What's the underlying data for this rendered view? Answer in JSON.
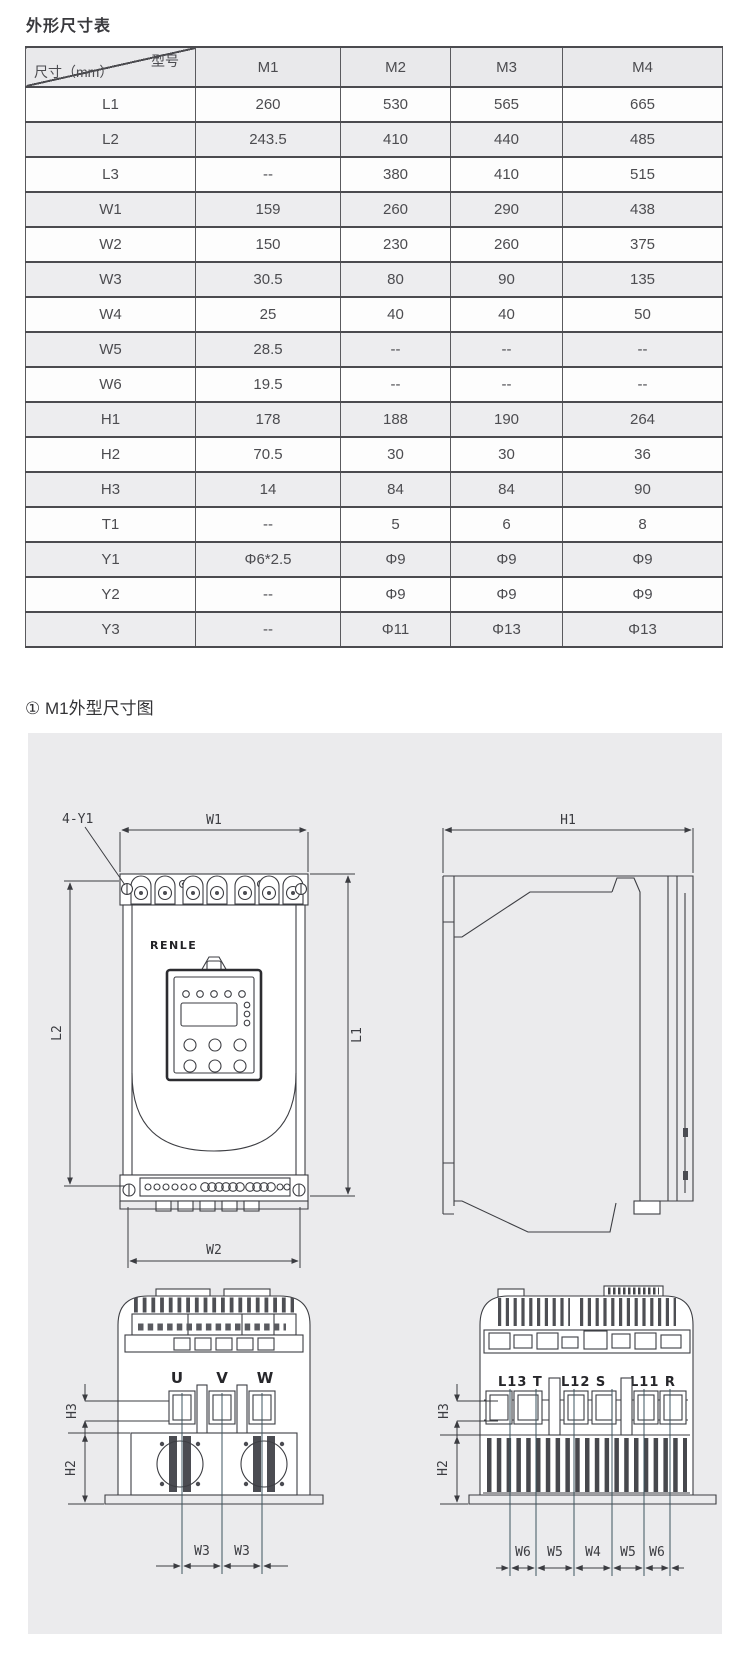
{
  "titles": {
    "table_title": "外形尺寸表",
    "section_title": "① M1外型尺寸图"
  },
  "table": {
    "corner": {
      "top_right": "型号",
      "bottom_left": "尺寸（mm）"
    },
    "columns": [
      "M1",
      "M2",
      "M3",
      "M4"
    ],
    "rows": [
      {
        "label": "L1",
        "values": [
          "260",
          "530",
          "565",
          "665"
        ]
      },
      {
        "label": "L2",
        "values": [
          "243.5",
          "410",
          "440",
          "485"
        ]
      },
      {
        "label": "L3",
        "values": [
          "--",
          "380",
          "410",
          "515"
        ]
      },
      {
        "label": "W1",
        "values": [
          "159",
          "260",
          "290",
          "438"
        ]
      },
      {
        "label": "W2",
        "values": [
          "150",
          "230",
          "260",
          "375"
        ]
      },
      {
        "label": "W3",
        "values": [
          "30.5",
          "80",
          "90",
          "135"
        ]
      },
      {
        "label": "W4",
        "values": [
          "25",
          "40",
          "40",
          "50"
        ]
      },
      {
        "label": "W5",
        "values": [
          "28.5",
          "--",
          "--",
          "--"
        ]
      },
      {
        "label": "W6",
        "values": [
          "19.5",
          "--",
          "--",
          "--"
        ]
      },
      {
        "label": "H1",
        "values": [
          "178",
          "188",
          "190",
          "264"
        ]
      },
      {
        "label": "H2",
        "values": [
          "70.5",
          "30",
          "30",
          "36"
        ]
      },
      {
        "label": "H3",
        "values": [
          "14",
          "84",
          "84",
          "90"
        ]
      },
      {
        "label": "T1",
        "values": [
          "--",
          "5",
          "6",
          "8"
        ]
      },
      {
        "label": "Y1",
        "values": [
          "Φ6*2.5",
          "Φ9",
          "Φ9",
          "Φ9"
        ]
      },
      {
        "label": "Y2",
        "values": [
          "--",
          "Φ9",
          "Φ9",
          "Φ9"
        ]
      },
      {
        "label": "Y3",
        "values": [
          "--",
          "Φ11",
          "Φ13",
          "Φ13"
        ]
      }
    ]
  },
  "diagram": {
    "brand": "RENLE",
    "front": {
      "hole": "4-Y1",
      "width_top": "W1",
      "height_left": "L2",
      "height_right": "L1",
      "width_bottom": "W2"
    },
    "side": {
      "depth": "H1"
    },
    "bottom_left": {
      "terminals": [
        "U",
        "V",
        "W"
      ],
      "h3": "H3",
      "h2": "H2",
      "w3_left": "W3",
      "w3_right": "W3"
    },
    "bottom_right": {
      "terminals": [
        "L13 T",
        "L12 S",
        "L11 R"
      ],
      "h3": "H3",
      "h2": "H2",
      "widths": [
        "W6",
        "W5",
        "W4",
        "W5",
        "W6"
      ]
    },
    "colors": {
      "canvas": "#ebebed",
      "line": "#3d3e43",
      "leader": "#3e5660"
    }
  }
}
